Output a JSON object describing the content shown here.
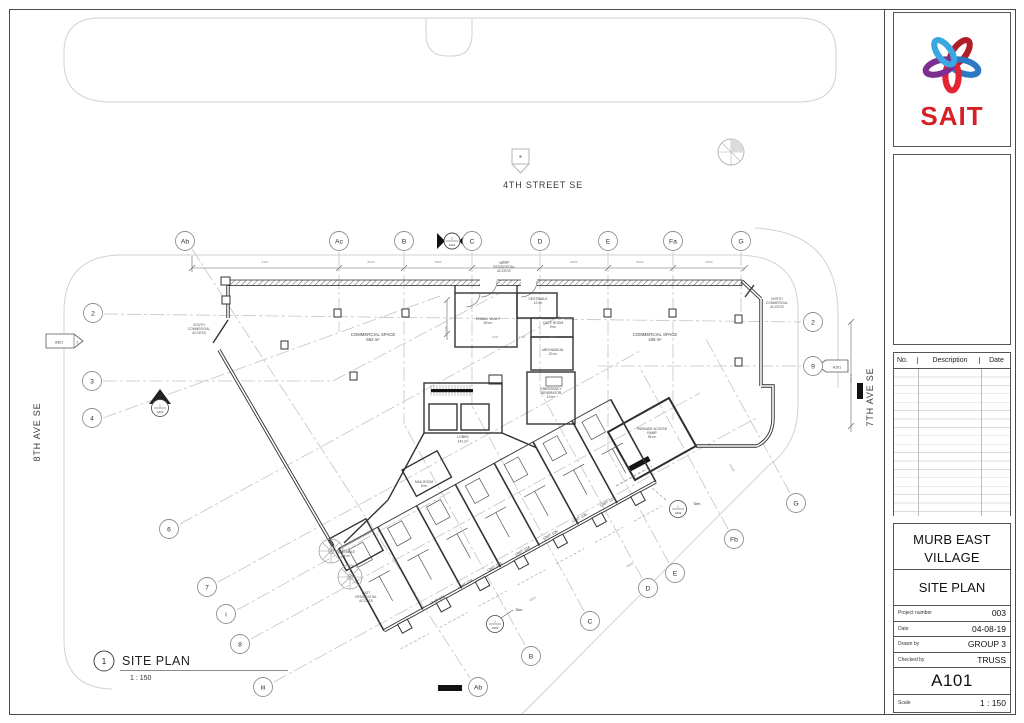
{
  "title_block": {
    "logo_text": "SAIT",
    "revision_table": {
      "headers": [
        "No.",
        "Description",
        "Date"
      ]
    },
    "project_name": "MURB EAST VILLAGE",
    "drawing_title": "SITE PLAN",
    "fields": [
      {
        "label": "Project number",
        "value": "003"
      },
      {
        "label": "Date",
        "value": "04-08-19"
      },
      {
        "label": "Drawn by",
        "value": "GROUP 3"
      },
      {
        "label": "Checked by",
        "value": "TRUSS"
      }
    ],
    "sheet_number": "A101",
    "scale_label": "Scale",
    "scale_value": "1 : 150"
  },
  "plan": {
    "streets": {
      "top": "4TH STREET SE",
      "left": "8TH AVE SE",
      "right": "7TH AVE SE"
    },
    "view_title": {
      "num": "1",
      "title": "SITE PLAN",
      "scale": "1 : 150"
    },
    "markers": {
      "flag_left_sheet": "A301",
      "flag_left_detail": "2",
      "diamond_num": "1",
      "diamond_sheet": "A401",
      "section_num": "1",
      "section_sheet": "A402",
      "callout_num": "1",
      "callout_sheet": "A402",
      "callout2_num": "1",
      "callout2_sheet": "A402",
      "flag_right_sheet": "A101"
    },
    "bubbles": [
      {
        "label": "Ab",
        "x": 185,
        "y": 241
      },
      {
        "label": "Ac",
        "x": 339,
        "y": 241
      },
      {
        "label": "B",
        "x": 404,
        "y": 241
      },
      {
        "label": "C",
        "x": 472,
        "y": 241
      },
      {
        "label": "D",
        "x": 540,
        "y": 241
      },
      {
        "label": "E",
        "x": 608,
        "y": 241
      },
      {
        "label": "Fa",
        "x": 673,
        "y": 241
      },
      {
        "label": "G",
        "x": 741,
        "y": 241
      },
      {
        "label": "2",
        "x": 93,
        "y": 313
      },
      {
        "label": "3",
        "x": 92,
        "y": 381
      },
      {
        "label": "4",
        "x": 92,
        "y": 418
      },
      {
        "label": "6",
        "x": 169,
        "y": 529
      },
      {
        "label": "7",
        "x": 207,
        "y": 587
      },
      {
        "label": "i",
        "x": 226,
        "y": 614
      },
      {
        "label": "8",
        "x": 240,
        "y": 644
      },
      {
        "label": "iii",
        "x": 263,
        "y": 687
      },
      {
        "label": "2",
        "x": 813,
        "y": 322
      },
      {
        "label": "9",
        "x": 813,
        "y": 366
      },
      {
        "label": "G",
        "x": 796,
        "y": 503
      },
      {
        "label": "Fb",
        "x": 734,
        "y": 539
      },
      {
        "label": "E",
        "x": 675,
        "y": 573
      },
      {
        "label": "D",
        "x": 648,
        "y": 588
      },
      {
        "label": "C",
        "x": 590,
        "y": 621
      },
      {
        "label": "B",
        "x": 531,
        "y": 656
      },
      {
        "label": "Ab",
        "x": 478,
        "y": 687
      }
    ],
    "labels": [
      {
        "n": "room-label-commercial-west",
        "lines": [
          "COMMERCIAL SPACE",
          "662 m²"
        ],
        "x": 373,
        "y": 336,
        "s": 4.3
      },
      {
        "n": "room-label-commercial-east",
        "lines": [
          "COMMERCIAL SPACE",
          "436 m²"
        ],
        "x": 655,
        "y": 336,
        "s": 4.3
      },
      {
        "n": "room-label-vestibule-west",
        "lines": [
          "VESTIBULE",
          "12 m²"
        ],
        "x": 538,
        "y": 300,
        "s": 3.5
      },
      {
        "n": "room-label-enmax-vault",
        "lines": [
          "ENMAX VAULT",
          "39 m²"
        ],
        "x": 488,
        "y": 320,
        "s": 3.5
      },
      {
        "n": "room-label-cacf-room",
        "lines": [
          "CACF ROOM",
          "9 m²"
        ],
        "x": 553,
        "y": 324,
        "s": 3.3
      },
      {
        "n": "room-label-mechanical",
        "lines": [
          "MECHANICAL",
          "20 m²"
        ],
        "x": 553,
        "y": 351,
        "s": 3.3
      },
      {
        "n": "room-label-emergency-generator",
        "lines": [
          "EMERGENCY",
          "GENERATOR",
          "13 m²"
        ],
        "x": 551,
        "y": 390,
        "s": 3.3
      },
      {
        "n": "room-label-lobby",
        "lines": [
          "LOBBY",
          "141 m²"
        ],
        "x": 463,
        "y": 438,
        "s": 3.6
      },
      {
        "n": "room-label-mail-room",
        "lines": [
          "MAIL ROOM",
          "8 m²"
        ],
        "x": 424,
        "y": 483,
        "s": 3.2
      },
      {
        "n": "room-label-parkade-ramp",
        "lines": [
          "PARKADE ACCESS",
          "RAMP",
          "95 m²"
        ],
        "x": 652,
        "y": 430,
        "s": 3.3
      },
      {
        "n": "room-label-vestibule-east",
        "lines": [
          "VESTIBULE",
          "14 m²"
        ],
        "x": 346,
        "y": 553,
        "s": 3.2
      },
      {
        "n": "access-label-west",
        "lines": [
          "WEST",
          "RESIDENTIAL",
          "ACCESS"
        ],
        "x": 504,
        "y": 264,
        "s": 3.3,
        "c": "#555"
      },
      {
        "n": "access-label-south",
        "lines": [
          "SOUTH",
          "COMMERCIAL",
          "ACCESS"
        ],
        "x": 199,
        "y": 326,
        "s": 3.3,
        "c": "#555"
      },
      {
        "n": "access-label-north",
        "lines": [
          "NORTH",
          "COMMERCIAL",
          "ACCESS"
        ],
        "x": 777,
        "y": 300,
        "s": 3.3,
        "c": "#555"
      },
      {
        "n": "access-label-east",
        "lines": [
          "EAST",
          "RESIDENTIAL",
          "ACCESS"
        ],
        "x": 366,
        "y": 594,
        "s": 3.3,
        "c": "#555"
      },
      {
        "n": "unit-label",
        "lines": [
          "UNIT 101"
        ],
        "x": 438,
        "y": 601,
        "s": 3.8,
        "r": -29
      },
      {
        "n": "unit-label",
        "lines": [
          "UNIT 102"
        ],
        "x": 466,
        "y": 585,
        "s": 3.8,
        "r": -29
      },
      {
        "n": "unit-label",
        "lines": [
          "UNIT 103"
        ],
        "x": 495,
        "y": 568,
        "s": 3.8,
        "r": -29
      },
      {
        "n": "unit-label",
        "lines": [
          "UNIT 104"
        ],
        "x": 523,
        "y": 552,
        "s": 3.8,
        "r": -29
      },
      {
        "n": "unit-label",
        "lines": [
          "UNIT 105"
        ],
        "x": 551,
        "y": 536,
        "s": 3.8,
        "r": -29
      },
      {
        "n": "unit-label",
        "lines": [
          "UNIT 106"
        ],
        "x": 580,
        "y": 519,
        "s": 3.8,
        "r": -29
      },
      {
        "n": "unit-label",
        "lines": [
          "UNIT 107"
        ],
        "x": 608,
        "y": 503,
        "s": 3.8,
        "r": -29
      },
      {
        "n": "sim-note",
        "lines": [
          "Sim"
        ],
        "x": 519,
        "y": 611,
        "s": 4,
        "c": "#333"
      },
      {
        "n": "sim-note",
        "lines": [
          "Sim"
        ],
        "x": 697,
        "y": 505,
        "s": 4,
        "c": "#333"
      },
      {
        "n": "dim-label",
        "lines": [
          "3437"
        ],
        "x": 265,
        "y": 263,
        "s": 3.1,
        "c": "#8a8a8a"
      },
      {
        "n": "dim-label",
        "lines": [
          "8000"
        ],
        "x": 371,
        "y": 263,
        "s": 3.1,
        "c": "#8a8a8a"
      },
      {
        "n": "dim-label",
        "lines": [
          "3000"
        ],
        "x": 438,
        "y": 263,
        "s": 3.1,
        "c": "#8a8a8a"
      },
      {
        "n": "dim-label",
        "lines": [
          "8000"
        ],
        "x": 506,
        "y": 263,
        "s": 3.1,
        "c": "#8a8a8a"
      },
      {
        "n": "dim-label",
        "lines": [
          "8000"
        ],
        "x": 574,
        "y": 263,
        "s": 3.1,
        "c": "#8a8a8a"
      },
      {
        "n": "dim-label",
        "lines": [
          "8000"
        ],
        "x": 640,
        "y": 263,
        "s": 3.1,
        "c": "#8a8a8a"
      },
      {
        "n": "dim-label",
        "lines": [
          "5000"
        ],
        "x": 709,
        "y": 263,
        "s": 3.1,
        "c": "#8a8a8a"
      },
      {
        "n": "dim-label",
        "lines": [
          "11130"
        ],
        "x": 447,
        "y": 330,
        "s": 3.1,
        "r": -90,
        "c": "#8a8a8a"
      },
      {
        "n": "dim-label",
        "lines": [
          "27147"
        ],
        "x": 852,
        "y": 378,
        "s": 3.1,
        "r": -90,
        "c": "#8a8a8a"
      },
      {
        "n": "dim-label",
        "lines": [
          "1200"
        ],
        "x": 495,
        "y": 338,
        "s": 2.7,
        "c": "#8a8a8a"
      },
      {
        "n": "dim-label",
        "lines": [
          "1700"
        ],
        "x": 522,
        "y": 338,
        "s": 2.7,
        "c": "#8a8a8a"
      },
      {
        "n": "dim-label",
        "lines": [
          "4177"
        ],
        "x": 553,
        "y": 338,
        "s": 2.7,
        "c": "#8a8a8a"
      },
      {
        "n": "dim-label",
        "lines": [
          "4500"
        ],
        "x": 533,
        "y": 600,
        "s": 3.1,
        "r": -29,
        "c": "#8a8a8a"
      },
      {
        "n": "dim-label",
        "lines": [
          "4500"
        ],
        "x": 630,
        "y": 566,
        "s": 3.1,
        "r": -29,
        "c": "#8a8a8a"
      },
      {
        "n": "dim-label",
        "lines": [
          "12192"
        ],
        "x": 731,
        "y": 468,
        "s": 3.1,
        "r": 62,
        "c": "#8a8a8a"
      }
    ]
  }
}
